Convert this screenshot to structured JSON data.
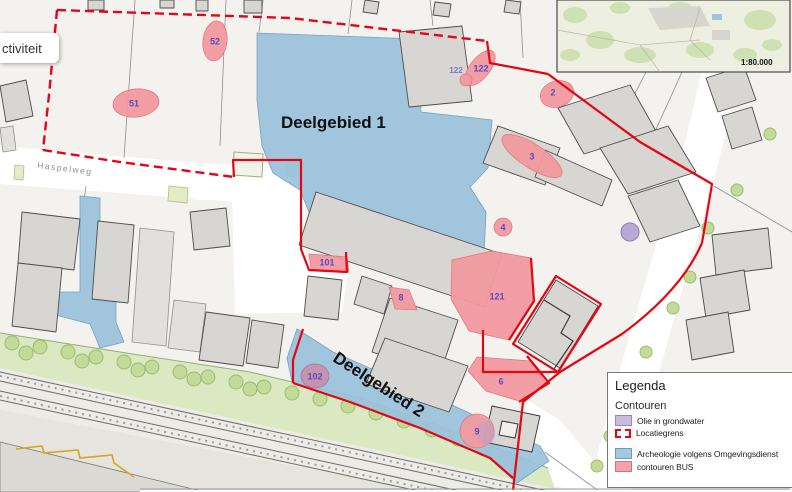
{
  "tooltip": {
    "text": "ctiviteit"
  },
  "area_labels": {
    "deelgebied1": "Deelgebied 1",
    "deelgebied2": "Deelgebied 2"
  },
  "street_labels": {
    "haspelweg": "Haspelweg"
  },
  "inset": {
    "scale": "1:80.000"
  },
  "markers": {
    "m51": "51",
    "m52": "52",
    "m122a": "122",
    "m122b": "122",
    "m2": "2",
    "m3": "3",
    "m4": "4",
    "m101": "101",
    "m8": "8",
    "m121": "121",
    "m102": "102",
    "m6": "6",
    "m9": "9"
  },
  "legend": {
    "title": "Legenda",
    "group_title": "Contouren",
    "items": [
      {
        "label": "Olie in grondwater",
        "swatch": "#c9bade"
      },
      {
        "label": "Locatiegrens",
        "swatch": "#e30613"
      },
      {
        "label": "Archeologie volgens Omgevingsdienst",
        "swatch": "#a3c8e0"
      },
      {
        "label": "contouren BUS",
        "swatch": "#f4a2a8"
      }
    ]
  },
  "colors": {
    "boundary_red": "#e30613",
    "archeology_blue": "#9ac2dc",
    "bus_pink": "#f29aa0",
    "oil_purple": "#b7a8d6",
    "green_strip": "#dbe9c3"
  }
}
